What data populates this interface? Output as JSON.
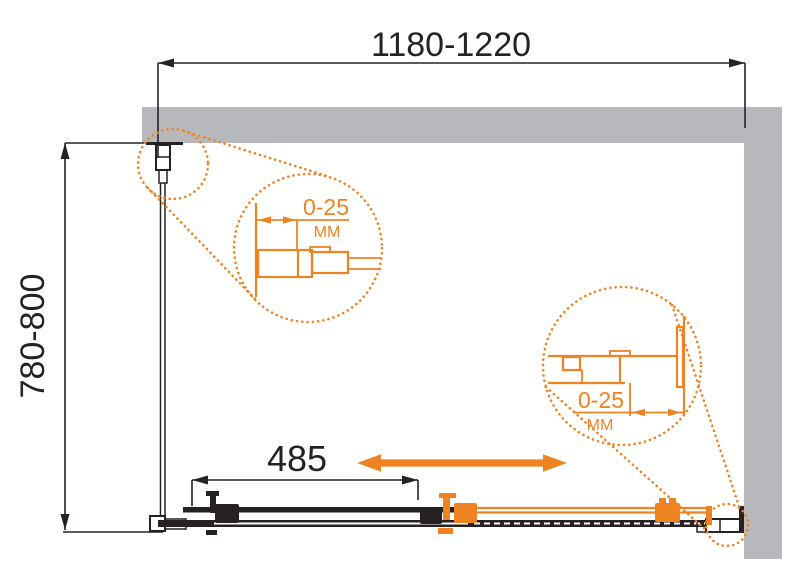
{
  "dimensions": {
    "width_range": "1180-1220",
    "depth_range": "780-800",
    "door_opening": "485"
  },
  "callouts": {
    "left": {
      "value": "0-25",
      "unit": "MM"
    },
    "right": {
      "value": "0-25",
      "unit": "MM"
    }
  },
  "colors": {
    "accent_orange": "#EF8322",
    "wall_gray": "#B6B8BB",
    "line_black": "#262223",
    "background": "#FFFFFF"
  }
}
